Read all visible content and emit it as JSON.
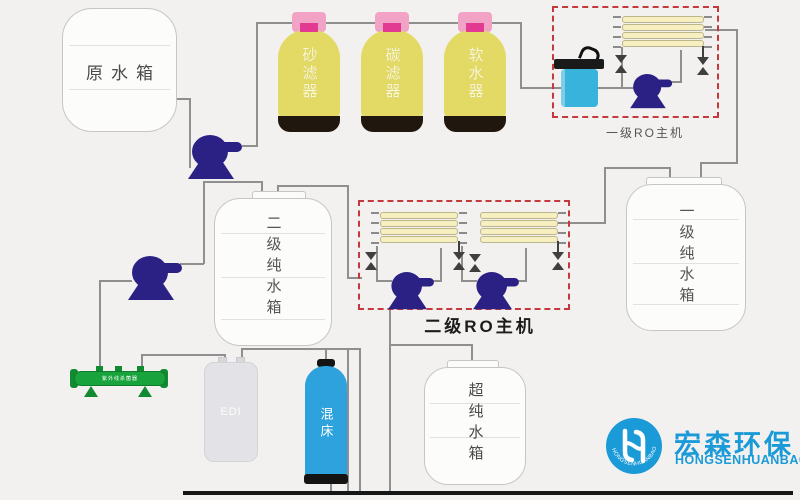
{
  "tanks": {
    "raw_water": {
      "label": "原水箱"
    },
    "stage2_pure": {
      "label": "二级纯水箱"
    },
    "stage1_pure": {
      "label": "一级纯水箱"
    },
    "ultra_pure": {
      "label": "超纯水箱"
    },
    "edi": {
      "label": "EDI"
    },
    "mixed_bed": {
      "label": "混床"
    }
  },
  "filters": [
    {
      "label": "砂滤器"
    },
    {
      "label": "碳滤器"
    },
    {
      "label": "软水器"
    }
  ],
  "ro_units": {
    "stage1": {
      "label": "一级RO主机"
    },
    "stage2": {
      "label": "二级RO主机"
    }
  },
  "devices": {
    "uv_sterilizer": {
      "label": "紫外线杀菌器"
    }
  },
  "logo": {
    "cn": "宏森环保",
    "en": "HONGSENHUANBAO",
    "arc_text": "HONGSENHUANBAO"
  },
  "colors": {
    "background": "#f2f1ef",
    "pipe": "#8f8f8f",
    "vessel_yellow": "#e3da66",
    "vessel_cap_pink": "#f2a2c4",
    "vessel_cap_magenta": "#e23a92",
    "vessel_base_black": "#20170e",
    "pump_navy": "#2b2184",
    "ro_box_red": "#c43a3c",
    "membrane_yellow": "#f6efbf",
    "mixed_bed_blue": "#2da2dc",
    "precision_filter_cyan": "#38b4dc",
    "uv_green": "#18a33c",
    "logo_blue": "#1b9ad8"
  }
}
